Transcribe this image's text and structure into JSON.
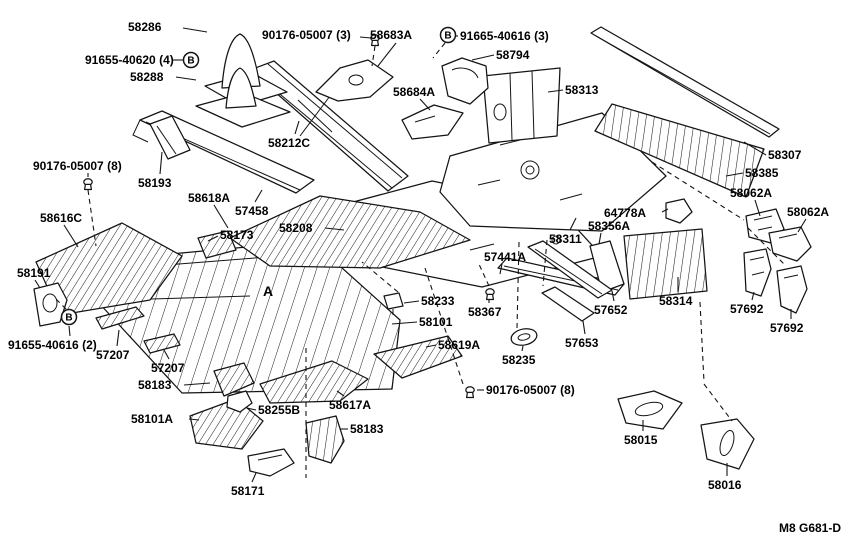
{
  "page": {
    "background": "#ffffff",
    "ink": "#141414"
  },
  "diagram": {
    "type": "exploded-parts-diagram",
    "figure_code": "M8 G681-D",
    "labels": [
      {
        "t": "58286",
        "x": 128,
        "y": 20,
        "l": [
          183,
          28,
          207,
          32
        ]
      },
      {
        "t": "90176-05007 (3)",
        "x": 262,
        "y": 28,
        "l": [
          360,
          37,
          371,
          38
        ]
      },
      {
        "t": "58683A",
        "x": 370,
        "y": 28,
        "l": [
          396,
          43,
          378,
          66
        ]
      },
      {
        "t": "91665-40616 (3)",
        "x": 460,
        "y": 29,
        "l": [
          458,
          36,
          452,
          36
        ]
      },
      {
        "t": "58794",
        "x": 496,
        "y": 48,
        "l": [
          494,
          55,
          472,
          60
        ]
      },
      {
        "t": "91655-40620 (4)",
        "x": 85,
        "y": 53,
        "l": [
          172,
          60,
          183,
          60
        ]
      },
      {
        "t": "58288",
        "x": 130,
        "y": 70,
        "l": [
          176,
          77,
          196,
          80
        ]
      },
      {
        "t": "58684A",
        "x": 393,
        "y": 85,
        "l": [
          420,
          99,
          430,
          110
        ]
      },
      {
        "t": "58313",
        "x": 565,
        "y": 83,
        "l": [
          563,
          90,
          548,
          92
        ]
      },
      {
        "t": "58212C",
        "x": 268,
        "y": 136,
        "l": [
          295,
          134,
          299,
          121
        ]
      },
      {
        "t": "58307",
        "x": 768,
        "y": 148,
        "l": [
          766,
          155,
          744,
          142
        ]
      },
      {
        "t": "58385",
        "x": 745,
        "y": 166,
        "l": [
          743,
          173,
          726,
          176
        ]
      },
      {
        "t": "90176-05007 (8)",
        "x": 33,
        "y": 159,
        "l": [
          88,
          173,
          88,
          177
        ]
      },
      {
        "t": "58193",
        "x": 138,
        "y": 176,
        "l": [
          160,
          174,
          162,
          152
        ]
      },
      {
        "t": "58618A",
        "x": 188,
        "y": 191,
        "l": [
          214,
          205,
          228,
          228
        ]
      },
      {
        "t": "57458",
        "x": 235,
        "y": 204,
        "l": [
          255,
          202,
          262,
          190
        ]
      },
      {
        "t": "58062A",
        "x": 730,
        "y": 186,
        "l": [
          755,
          200,
          760,
          216
        ]
      },
      {
        "t": "58062A",
        "x": 787,
        "y": 205,
        "l": [
          806,
          219,
          798,
          232
        ]
      },
      {
        "t": "58616C",
        "x": 40,
        "y": 211,
        "l": [
          64,
          225,
          78,
          247
        ]
      },
      {
        "t": "64778A",
        "x": 604,
        "y": 206,
        "l": [
          662,
          212,
          668,
          209
        ]
      },
      {
        "t": "58208",
        "x": 279,
        "y": 221,
        "l": [
          325,
          228,
          344,
          230
        ]
      },
      {
        "t": "58173",
        "x": 220,
        "y": 228,
        "l": [
          218,
          236,
          208,
          241
        ]
      },
      {
        "t": "58356A",
        "x": 588,
        "y": 219,
        "l": [
          601,
          233,
          599,
          244
        ]
      },
      {
        "t": "58311",
        "x": 549,
        "y": 232,
        "l": [
          570,
          230,
          576,
          218
        ]
      },
      {
        "t": "57441A",
        "x": 484,
        "y": 250,
        "l": [
          502,
          264,
          500,
          274
        ]
      },
      {
        "t": "58191",
        "x": 17,
        "y": 266,
        "l": [
          35,
          280,
          40,
          288
        ]
      },
      {
        "t": "58233",
        "x": 421,
        "y": 294,
        "l": [
          419,
          301,
          404,
          303
        ]
      },
      {
        "t": "58367",
        "x": 468,
        "y": 305,
        "l": [
          489,
          303,
          489,
          299
        ]
      },
      {
        "t": "57652",
        "x": 594,
        "y": 303,
        "l": [
          614,
          301,
          612,
          291
        ]
      },
      {
        "t": "58314",
        "x": 659,
        "y": 294,
        "l": [
          678,
          292,
          678,
          277
        ]
      },
      {
        "t": "57692",
        "x": 730,
        "y": 302,
        "l": [
          752,
          300,
          754,
          292
        ]
      },
      {
        "t": "57692",
        "x": 770,
        "y": 321,
        "l": [
          791,
          319,
          791,
          309
        ]
      },
      {
        "t": "58101",
        "x": 419,
        "y": 315,
        "l": [
          417,
          322,
          392,
          324
        ]
      },
      {
        "t": "91655-40616 (2)",
        "x": 8,
        "y": 338,
        "l": [
          70,
          336,
          69,
          326
        ]
      },
      {
        "t": "57207",
        "x": 96,
        "y": 348,
        "l": [
          117,
          346,
          119,
          330
        ]
      },
      {
        "t": "57207",
        "x": 151,
        "y": 361,
        "l": [
          169,
          359,
          164,
          350
        ]
      },
      {
        "t": "58619A",
        "x": 438,
        "y": 338,
        "l": [
          436,
          345,
          426,
          347
        ]
      },
      {
        "t": "58235",
        "x": 502,
        "y": 353,
        "l": [
          522,
          351,
          523,
          346
        ]
      },
      {
        "t": "57653",
        "x": 565,
        "y": 336,
        "l": [
          585,
          334,
          583,
          321
        ]
      },
      {
        "t": "58183",
        "x": 138,
        "y": 378,
        "l": [
          184,
          385,
          210,
          383
        ]
      },
      {
        "t": "58101A",
        "x": 131,
        "y": 412,
        "l": [
          189,
          419,
          199,
          420
        ]
      },
      {
        "t": "58255B",
        "x": 258,
        "y": 403,
        "l": [
          256,
          410,
          247,
          408
        ]
      },
      {
        "t": "58617A",
        "x": 329,
        "y": 398,
        "l": [
          344,
          396,
          337,
          391
        ]
      },
      {
        "t": "90176-05007 (8)",
        "x": 486,
        "y": 383,
        "l": [
          484,
          390,
          477,
          390
        ]
      },
      {
        "t": "58183",
        "x": 350,
        "y": 422,
        "l": [
          348,
          429,
          340,
          429
        ]
      },
      {
        "t": "58171",
        "x": 231,
        "y": 484,
        "l": [
          252,
          482,
          256,
          473
        ]
      },
      {
        "t": "58015",
        "x": 624,
        "y": 433,
        "l": [
          643,
          431,
          643,
          420
        ]
      },
      {
        "t": "58016",
        "x": 708,
        "y": 478,
        "l": [
          727,
          476,
          727,
          463
        ]
      },
      {
        "t": "A",
        "x": 263,
        "y": 283,
        "m": true
      }
    ],
    "symbols": [
      {
        "letter": "B",
        "x": 191,
        "y": 60
      },
      {
        "letter": "B",
        "x": 448,
        "y": 35
      },
      {
        "letter": "B",
        "x": 69,
        "y": 317
      }
    ]
  }
}
